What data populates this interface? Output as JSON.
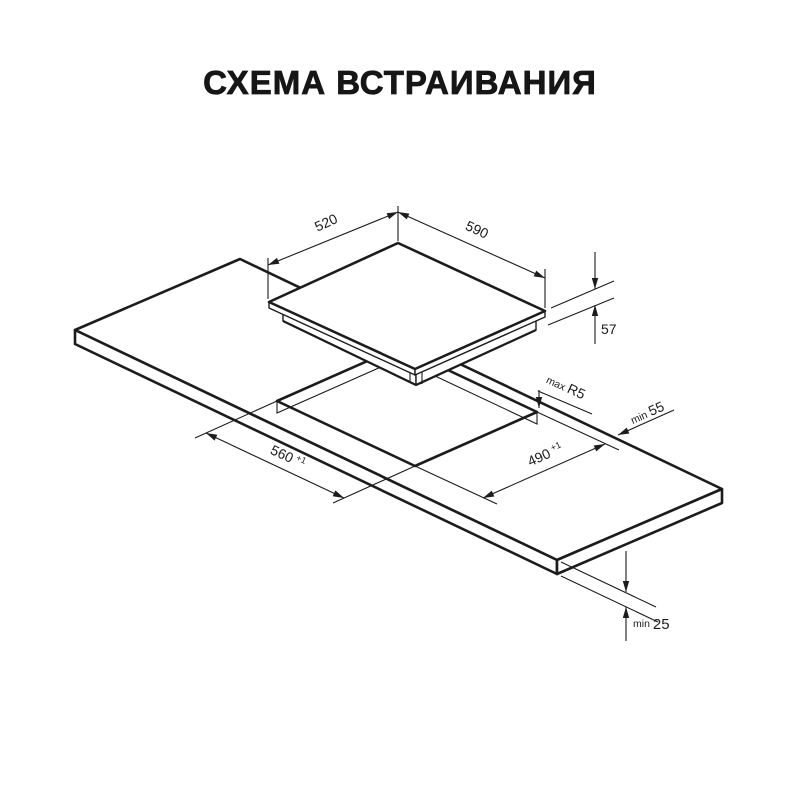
{
  "title": "СХЕМА ВСТРАИВАНИЯ",
  "colors": {
    "ink": "#1c1c1c",
    "background": "#ffffff"
  },
  "labels": {
    "hob_depth": "520",
    "hob_width": "590",
    "hob_height": "57",
    "corner_prefix": "max",
    "corner_radius": "R5",
    "rear_gap_prefix": "min",
    "rear_gap": "55",
    "cutout_width": "560",
    "cutout_width_tol": "+1",
    "cutout_depth": "490",
    "cutout_depth_tol": "+1",
    "under_gap_prefix": "min",
    "under_gap": "25"
  }
}
